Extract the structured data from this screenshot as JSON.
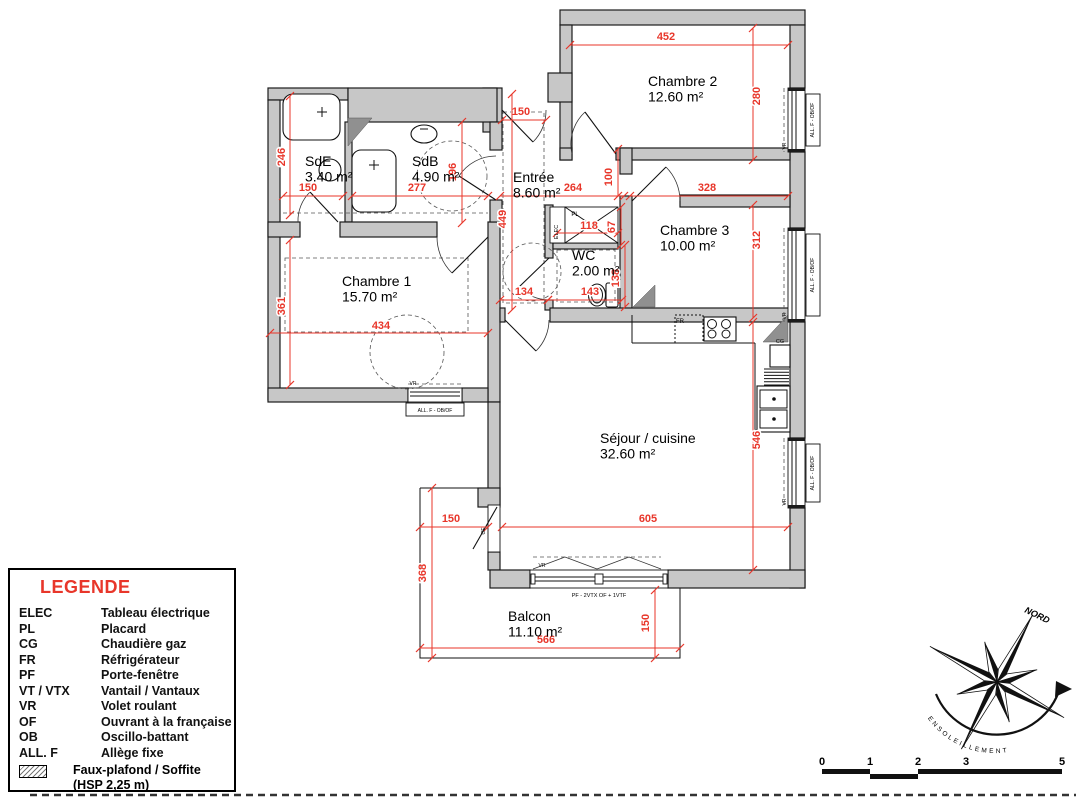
{
  "colors": {
    "dim_red": "#e8362a",
    "wall_gray": "#c7c7c7",
    "legend_title_red": "#e8362a"
  },
  "rooms": [
    {
      "id": "chambre-2",
      "name": "Chambre 2",
      "area": "12.60 m²",
      "x": 648,
      "y": 86
    },
    {
      "id": "sde",
      "name": "SdE",
      "area": "3.40 m²",
      "x": 305,
      "y": 166
    },
    {
      "id": "sdb",
      "name": "SdB",
      "area": "4.90 m²",
      "x": 412,
      "y": 166
    },
    {
      "id": "entree",
      "name": "Entrée",
      "area": "8.60 m²",
      "x": 513,
      "y": 182
    },
    {
      "id": "chambre-3",
      "name": "Chambre 3",
      "area": "10.00 m²",
      "x": 660,
      "y": 235
    },
    {
      "id": "wc",
      "name": "WC",
      "area": "2.00 m²",
      "x": 572,
      "y": 260
    },
    {
      "id": "chambre-1",
      "name": "Chambre 1",
      "area": "15.70 m²",
      "x": 342,
      "y": 286
    },
    {
      "id": "sejour",
      "name": "Séjour / cuisine",
      "area": "32.60 m²",
      "x": 600,
      "y": 443
    },
    {
      "id": "balcon",
      "name": "Balcon",
      "area": "11.10 m²",
      "x": 508,
      "y": 621
    }
  ],
  "dimensions": [
    {
      "v": "452",
      "o": "h",
      "x": 570,
      "y": 45,
      "len": 218,
      "lx": 666,
      "ly": 40
    },
    {
      "v": "150",
      "o": "h",
      "x": 283,
      "y": 196,
      "len": 60,
      "lx": 308,
      "ly": 191
    },
    {
      "v": "277",
      "o": "h",
      "x": 352,
      "y": 196,
      "len": 136,
      "lx": 417,
      "ly": 191
    },
    {
      "v": "150",
      "o": "h",
      "x": 502,
      "y": 120,
      "len": 44,
      "lx": 521,
      "ly": 115
    },
    {
      "v": "264",
      "o": "h",
      "x": 500,
      "y": 196,
      "len": 124,
      "lx": 573,
      "ly": 191
    },
    {
      "v": "328",
      "o": "h",
      "x": 630,
      "y": 196,
      "len": 158,
      "lx": 707,
      "ly": 191
    },
    {
      "v": "118",
      "o": "h",
      "x": 557,
      "y": 233,
      "len": 61,
      "lx": 589,
      "ly": 229
    },
    {
      "v": "434",
      "o": "h",
      "x": 270,
      "y": 333,
      "len": 218,
      "lx": 381,
      "ly": 329
    },
    {
      "v": "134",
      "o": "h",
      "x": 500,
      "y": 300,
      "len": 48,
      "lx": 524,
      "ly": 295
    },
    {
      "v": "143",
      "o": "h",
      "x": 548,
      "y": 300,
      "len": 74,
      "lx": 590,
      "ly": 295
    },
    {
      "v": "605",
      "o": "h",
      "x": 502,
      "y": 527,
      "len": 286,
      "lx": 648,
      "ly": 522
    },
    {
      "v": "150",
      "o": "h",
      "x": 420,
      "y": 527,
      "len": 68,
      "lx": 451,
      "ly": 522
    },
    {
      "v": "566",
      "o": "h",
      "x": 420,
      "y": 648,
      "len": 260,
      "lx": 546,
      "ly": 643
    },
    {
      "v": "280",
      "o": "v",
      "x": 753,
      "y": 28,
      "len": 132,
      "lx": 760,
      "ly": 96
    },
    {
      "v": "246",
      "o": "v",
      "x": 290,
      "y": 96,
      "len": 119,
      "lx": 285,
      "ly": 157
    },
    {
      "v": "196",
      "o": "v",
      "x": 462,
      "y": 122,
      "len": 101,
      "lx": 456,
      "ly": 172
    },
    {
      "v": "449",
      "o": "v",
      "x": 512,
      "y": 94,
      "len": 216,
      "lx": 506,
      "ly": 219
    },
    {
      "v": "100",
      "o": "v",
      "x": 618,
      "y": 149,
      "len": 47,
      "lx": 612,
      "ly": 177
    },
    {
      "v": "312",
      "o": "v",
      "x": 753,
      "y": 205,
      "len": 113,
      "lx": 760,
      "ly": 240
    },
    {
      "v": "67",
      "o": "v",
      "x": 621,
      "y": 207,
      "len": 38,
      "lx": 615,
      "ly": 227
    },
    {
      "v": "361",
      "o": "v",
      "x": 290,
      "y": 240,
      "len": 145,
      "lx": 285,
      "ly": 306
    },
    {
      "v": "138",
      "o": "v",
      "x": 625,
      "y": 245,
      "len": 62,
      "lx": 619,
      "ly": 278
    },
    {
      "v": "546",
      "o": "v",
      "x": 753,
      "y": 322,
      "len": 248,
      "lx": 760,
      "ly": 440
    },
    {
      "v": "368",
      "o": "v",
      "x": 432,
      "y": 488,
      "len": 170,
      "lx": 426,
      "ly": 573
    },
    {
      "v": "150",
      "o": "v",
      "x": 655,
      "y": 590,
      "len": 68,
      "lx": 649,
      "ly": 623
    }
  ],
  "tags": [
    {
      "t": "PL",
      "x": 575,
      "y": 216,
      "fs": 6,
      "r": 0
    },
    {
      "t": "ELEC",
      "x": 558,
      "y": 232,
      "fs": 5.5,
      "r": -90
    },
    {
      "t": "FR",
      "x": 680,
      "y": 323,
      "fs": 6,
      "r": 0
    },
    {
      "t": "CG",
      "x": 780,
      "y": 343,
      "fs": 5.5,
      "r": 0
    },
    {
      "t": "VR",
      "x": 786,
      "y": 146,
      "fs": 5,
      "r": -90
    },
    {
      "t": "VR",
      "x": 786,
      "y": 316,
      "fs": 5,
      "r": -90
    },
    {
      "t": "VR",
      "x": 786,
      "y": 502,
      "fs": 5,
      "r": -90
    },
    {
      "t": "VR",
      "x": 413,
      "y": 385,
      "fs": 5,
      "r": 0
    },
    {
      "t": "VR",
      "x": 542,
      "y": 567,
      "fs": 5,
      "r": 0
    },
    {
      "t": "OF",
      "x": 485,
      "y": 531,
      "fs": 5,
      "r": -90
    },
    {
      "t": "ALL. F - OB/OF",
      "x": 814,
      "y": 120,
      "fs": 5,
      "r": -90
    },
    {
      "t": "ALL. F - OB/OF",
      "x": 814,
      "y": 275,
      "fs": 5,
      "r": -90
    },
    {
      "t": "ALL. F - OB/OF",
      "x": 814,
      "y": 473,
      "fs": 5,
      "r": -90
    },
    {
      "t": "ALL. F - OB/OF",
      "x": 435,
      "y": 412,
      "fs": 5,
      "r": 0
    },
    {
      "t": "PF - 2VTX OF + 1VTF",
      "x": 599,
      "y": 597,
      "fs": 5.5,
      "r": 0
    }
  ],
  "legend": {
    "title": "LEGENDE",
    "entries": [
      {
        "abbr": "ELEC",
        "label": "Tableau électrique"
      },
      {
        "abbr": "PL",
        "label": "Placard"
      },
      {
        "abbr": "CG",
        "label": "Chaudière gaz"
      },
      {
        "abbr": "FR",
        "label": "Réfrigérateur"
      },
      {
        "abbr": "PF",
        "label": "Porte-fenêtre"
      },
      {
        "abbr": "VT / VTX",
        "label": "Vantail / Vantaux"
      },
      {
        "abbr": "VR",
        "label": "Volet roulant"
      },
      {
        "abbr": "OF",
        "label": "Ouvrant à la française"
      },
      {
        "abbr": "OB",
        "label": "Oscillo-battant"
      },
      {
        "abbr": "ALL. F",
        "label": "Allège fixe"
      }
    ],
    "hatch": {
      "label": "Faux-plafond / Soffite",
      "sub": "(HSP 2,25 m)"
    }
  },
  "compass": {
    "north": "NORD",
    "sun": "ENSOLEILLEMENT"
  },
  "scale_bar": {
    "labels": [
      "0",
      "1",
      "2",
      "3",
      "5"
    ]
  }
}
